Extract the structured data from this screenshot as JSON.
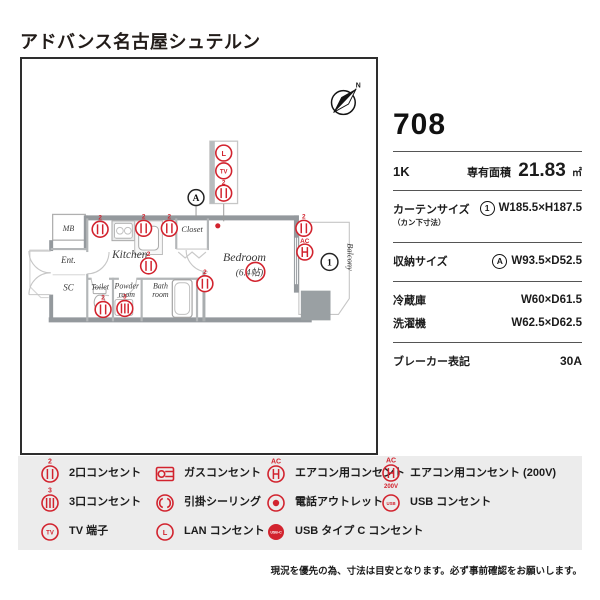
{
  "title": "アドバンス名古屋シュテルン",
  "plan": {
    "labels": {
      "mb": "MB",
      "ent": "Ent.",
      "sc": "SC",
      "kitchen": "Kitchen",
      "toilet": "Toilet",
      "powder_1": "Powder",
      "powder_2": "room",
      "bath_1": "Bath",
      "bath_2": "room",
      "closet": "Closet",
      "bedroom": "Bedroom",
      "bedroom_size": "(6.4帖)",
      "balcony": "Balcony"
    },
    "tags": {
      "storage": "A",
      "window": "1",
      "north": "N"
    },
    "marks": {
      "sup2": "2",
      "sup3": "3",
      "ac": "AC",
      "tv": "TV",
      "lan": "L"
    }
  },
  "info": {
    "room_number": "708",
    "layout": "1K",
    "area_label": "専有面積",
    "area_value": "21.83",
    "area_unit": "㎡",
    "curtain_label": "カーテンサイズ",
    "curtain_sub": "（カン下寸法）",
    "curtain_tag": "1",
    "curtain_value": "W185.5×H187.5",
    "storage_label": "収納サイズ",
    "storage_tag": "A",
    "storage_value": "W93.5×D52.5",
    "fridge_label": "冷蔵庫",
    "fridge_value": "W60×D61.5",
    "washer_label": "洗濯機",
    "washer_value": "W62.5×D62.5",
    "breaker_label": "ブレーカー表記",
    "breaker_value": "30A"
  },
  "legend": {
    "items": [
      {
        "label": "2口コンセント",
        "sup": "2"
      },
      {
        "label": "ガスコンセント"
      },
      {
        "label": "エアコン用コンセント",
        "sup": "AC"
      },
      {
        "label": "エアコン用コンセント (200V)",
        "sup": "AC",
        "sub": "200V"
      },
      {
        "label": "3口コンセント",
        "sup": "3"
      },
      {
        "label": "引掛シーリング"
      },
      {
        "label": "電話アウトレット"
      },
      {
        "label": "USB コンセント",
        "text": "USB"
      },
      {
        "label": "TV 端子",
        "text": "TV"
      },
      {
        "label": "LAN コンセント",
        "text": "L"
      },
      {
        "label": "USB タイプ C コンセント",
        "text": "USB-C"
      }
    ]
  },
  "note": "現況を優先の為、寸法は目安となります。必ず事前確認をお願いします。",
  "colors": {
    "accent": "#d2232e",
    "wall": "#94999d",
    "legend_bg": "#ececec"
  }
}
